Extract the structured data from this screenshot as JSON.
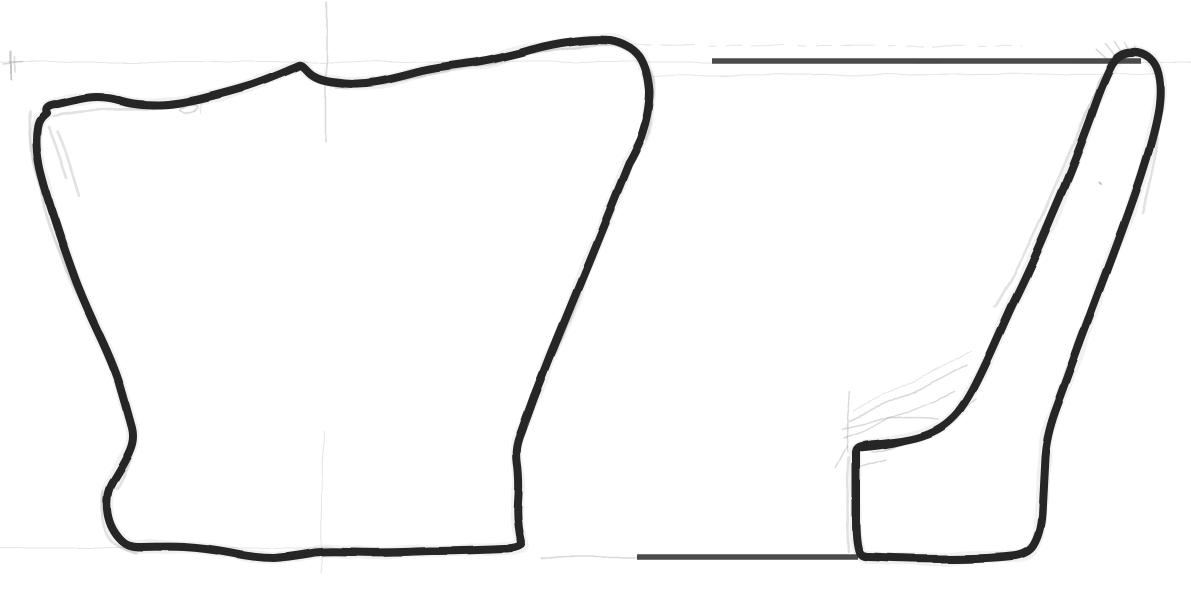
{
  "canvas": {
    "width": 1191,
    "height": 590
  },
  "colors": {
    "paper": "#ffffff",
    "ink": "#262626",
    "pencil": "#8f8f8f",
    "guide": "#4a4a4a"
  },
  "drawing": {
    "front_outline": {
      "path": "M 47,113 C 44,107 50,104 58,104 C 72,101 85,97 97,97 C 106,97 112,98 122,101 C 132,104 146,105 158,105 C 172,105 186,102 200,99 C 216,95 232,91 248,86 C 264,81 280,74 292,69 L 299,66 C 302,65 304,68 308,72 C 314,78 324,81 336,82 C 348,84 362,84 374,82 C 390,80 406,75 422,71 C 440,67 458,65 472,63 C 488,61 504,57 520,53 C 536,48 553,44 568,42 C 582,40 597,39 610,40 C 622,42 633,48 640,57 C 646,66 649,78 650,92 C 650,106 647,122 641,139 C 637,148 634,155 629,163 L 591,257 L 552,352 L 534,398 L 521,434 C 517,444 516,452 517,462 C 519,476 519,490 518,503 C 517,518 519,532 522,545 C 518,548 512,549 504,549 C 480,550 455,551 430,551 C 405,552 380,553 355,552 C 338,552 322,551 312,553 C 300,555 288,557 274,558 C 260,558 246,556 232,553 C 216,550 200,548 184,547 C 168,546 152,547 138,547 C 130,547 124,544 119,538 C 112,530 108,521 107,509 C 106,498 108,489 113,481 C 119,471 126,460 130,450 C 133,443 134,436 132,428 C 128,413 123,396 119,382 C 115,370 108,353 100,336 C 91,317 83,299 76,281 C 69,262 62,242 56,223 C 50,205 44,186 40,169 C 37,154 36,140 38,128 C 39,121 42,117 47,113 Z"
    },
    "section_outline": {
      "path": "M 1132,53 C 1124,53 1117,57 1112,65 C 1105,78 1098,96 1090,120 C 1079,150 1067,181 1053,213 C 1040,244 1027,274 1013,302 C 1004,321 994,345 984,366 C 975,385 968,399 958,412 C 948,424 937,431 922,436 C 910,440 901,441 893,442 C 881,444 868,444 862,446 C 858,447 856,449 856,453 C 856,476 856,499 856,521 C 856,533 857,544 859,551 C 860,555 863,557 869,557 C 893,558 919,559 945,559 C 969,559 992,558 1012,556 C 1022,555 1029,552 1033,546 C 1038,538 1041,527 1042,514 C 1043,495 1044,475 1045,457 C 1046,443 1049,429 1055,412 C 1063,390 1072,365 1082,338 C 1093,309 1104,280 1115,250 C 1125,223 1135,196 1143,170 C 1150,148 1156,127 1159,108 C 1161,93 1161,80 1157,69 C 1154,61 1148,55 1140,53 C 1137,52 1134,52 1132,53 Z"
    },
    "ledge_overstroke": {
      "path": "M 862,448 C 884,446 903,443 920,436"
    },
    "rim_level_bar": {
      "path": "M 712,61 L 1141,61"
    },
    "base_level_bar": {
      "path": "M 637,557 L 858,557"
    },
    "pencil": {
      "h_rim_level": {
        "path": "M 0,62 L 1191,62"
      },
      "h_upper_dashed": {
        "path": "M 636,45 L 1022,46"
      },
      "h_mid_faint": {
        "path": "M 642,76 L 1155,73"
      },
      "h_base_left": {
        "path": "M 0,548 L 333,548"
      },
      "h_base_connector": {
        "path": "M 540,557 L 637,557"
      },
      "v_center_upper": {
        "path": "M 326,2 L 326,142"
      },
      "v_center_lower": {
        "path": "M 323,430 L 322,574"
      },
      "reg_tick_v": {
        "path": "M 11,52 L 11,79"
      },
      "reg_tick_v2": {
        "path": "M 15,57 L 15,72"
      },
      "reg_tick_h": {
        "path": "M 3,64 L 23,62"
      },
      "squiggle_top": {
        "path": "M 180,111 C 186,115 194,113 198,107 C 194,103 185,105 180,111"
      },
      "tick_top": {
        "path": "M 202,99 L 200,113"
      },
      "ghost_left_edge": {
        "path": "M 31,112 C 29,152 40,205 61,255 C 72,282 82,303 92,322"
      },
      "ghost_left_bulge": {
        "path": "M 96,330 C 107,363 124,394 131,421 C 137,449 128,472 117,489"
      },
      "ghost_bottom_left": {
        "path": "M 103,492 C 99,513 101,529 111,541 C 118,548 127,551 136,553"
      },
      "ghost_top_left": {
        "path": "M 54,116 C 90,108 128,110 164,110"
      },
      "scribble_corner_1": {
        "path": "M 58,132 C 66,152 72,172 79,196"
      },
      "scribble_corner_2": {
        "path": "M 49,127 C 55,143 60,160 66,178"
      },
      "ghost_top_right": {
        "path": "M 336,88 C 400,82 470,66 540,52 C 570,47 595,44 614,45 C 636,52 650,64 653,80 C 655,97 651,118 645,138"
      },
      "ghost_right_diag": {
        "path": "M 627,172 L 556,352"
      },
      "ghost_inner_wall": {
        "path": "M 1101,76 C 1086,114 1068,157 1049,200 C 1030,244 1012,279 995,307"
      },
      "ghost_outer_wall": {
        "path": "M 1163,96 C 1161,132 1153,172 1142,212"
      },
      "ghost_outer_lower": {
        "path": "M 1087,312 C 1073,348 1059,388 1052,422"
      },
      "ghost_foot_left": {
        "path": "M 849,458 C 847,490 847,522 849,552"
      },
      "flare_ledge_1": {
        "path": "M 841,428 C 872,420 905,416 938,419"
      },
      "flare_ledge_2": {
        "path": "M 843,437 C 880,424 920,408 955,392"
      },
      "flare_ledge_3": {
        "path": "M 848,420 C 888,402 930,386 966,364"
      },
      "flare_ledge_4": {
        "path": "M 853,410 C 893,390 935,372 970,350"
      },
      "flare_ledge_5": {
        "path": "M 872,452 C 912,446 946,426 976,399"
      },
      "flare_ledge_6": {
        "path": "M 862,467 L 886,460"
      },
      "flare_ledge_7": {
        "path": "M 850,392 C 846,412 845,432 848,452"
      },
      "flare_ledge_8": {
        "path": "M 836,468 C 840,459 844,452 847,446"
      },
      "flare_rim_1": {
        "path": "M 1108,60 L 1096,49"
      },
      "flare_rim_2": {
        "path": "M 1116,57 L 1106,44"
      },
      "flare_rim_3": {
        "path": "M 1123,55 L 1115,42"
      },
      "flare_rim_4": {
        "path": "M 1130,54 L 1125,43"
      },
      "flare_rim_5": {
        "path": "M 1137,55 L 1135,45"
      },
      "dot_1": {
        "path": "M 1100,183 l 1.5,1.5"
      }
    }
  }
}
